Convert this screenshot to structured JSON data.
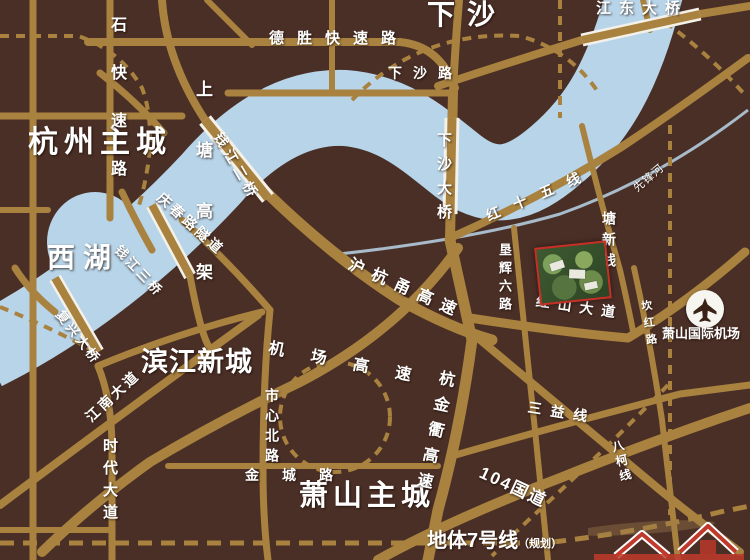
{
  "regions": {
    "hangzhou": "杭州主城",
    "xiasha": "下沙",
    "xihu": "西湖",
    "binjiang": "滨江新城",
    "xiaoshan": "萧山主城"
  },
  "roads": {
    "qiushi": "秋石快速路",
    "shangtang": "上塘高架",
    "desheng": "德胜快速路",
    "xiasha_rd": "下沙路",
    "jiangdong_bridge": "江东大桥",
    "qianjiang2_bridge": "钱江二桥",
    "qingchun_tunnel": "庆春路隧道",
    "qianjiang3_bridge": "钱江三桥",
    "fuxing_bridge": "复兴大桥",
    "xiasha_bridge": "下沙大桥",
    "hongshiwu": "红十五线",
    "tangxin": "塘新线",
    "kenhui": "垦辉六路",
    "hongshan": "红山大道",
    "kanhong": "坎红路",
    "huhangyong": "沪杭甬高速",
    "jichang": "机场高速",
    "hangjinqu": "杭金衢高速",
    "jiangnan": "江南大道",
    "shidai": "时代大道",
    "shixin": "市心北路",
    "jincheng": "金城路",
    "sanyi": "三益线",
    "guodao104": "104国道",
    "bake": "八柯线"
  },
  "water": {
    "xianfeng_river": "先锋河"
  },
  "poi": {
    "airport": "萧山国际机场"
  },
  "metro": {
    "line7": "地体7号线",
    "planned": "（规划）"
  },
  "colors": {
    "background": "#4a2f26",
    "road": "#a9823f",
    "river": "#b7d4e9",
    "label_text": "#ffffff",
    "site_border": "#c53026",
    "airport_circle": "#f7f5ef"
  }
}
